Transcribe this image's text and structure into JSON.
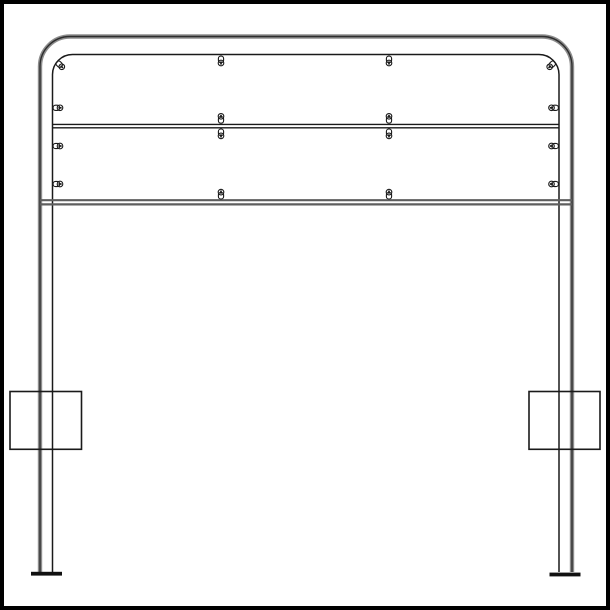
{
  "drawing": {
    "kind": "technical-elevation-line-drawing",
    "canvas": {
      "width": 610,
      "height": 610,
      "background": "#ffffff"
    },
    "border": {
      "color": "#000000",
      "stroke_width": 4,
      "inset": 2
    },
    "colors": {
      "line": "#1a1a1a",
      "tube_halo": "#8d8d8d",
      "tube_core": "#2e2e2e",
      "rail_gray": "#5e5e5e",
      "foot_fill": "#111111"
    },
    "tube_frame": {
      "outer": {
        "left_x": 40,
        "right_x": 572,
        "top_y": 36.5,
        "corner_radius": 30,
        "bottom_y": 572,
        "halo_width": 4.4,
        "core_width": 1.4
      },
      "inner": {
        "left_x": 52.5,
        "right_x": 559,
        "top_y": 54.5,
        "corner_radius": 20,
        "bottom_y": 572,
        "stroke_width": 1.5
      }
    },
    "rails": [
      {
        "name": "panel-divider-rail",
        "lines_y": [
          124.4,
          127.8
        ],
        "x1": 52.5,
        "x2": 559,
        "color_key": "line",
        "stroke_width": 1.4
      },
      {
        "name": "bottom-rail",
        "lines_y": [
          200.2,
          204.4
        ],
        "x1": 40,
        "x2": 572,
        "color_key": "rail_gray",
        "stroke_width": 2.2
      }
    ],
    "feet": [
      {
        "name": "left-foot-plate",
        "x": 31,
        "y": 571.8,
        "w": 31,
        "h": 3.8
      },
      {
        "name": "right-foot-plate",
        "x": 549.5,
        "y": 572.6,
        "w": 31,
        "h": 3.8
      }
    ],
    "side_boxes": [
      {
        "name": "left-side-box",
        "x": 10,
        "y": 391.5,
        "w": 71.5,
        "h": 57.8,
        "stroke_width": 1.6
      },
      {
        "name": "right-side-box",
        "x": 529,
        "y": 391.5,
        "w": 71,
        "h": 57.8,
        "stroke_width": 1.6
      }
    ],
    "fasteners": [
      {
        "x": 52.5,
        "y": 107.8,
        "angle": 0
      },
      {
        "x": 52.5,
        "y": 146.0,
        "angle": 0
      },
      {
        "x": 52.5,
        "y": 184.0,
        "angle": 0
      },
      {
        "x": 559,
        "y": 107.8,
        "angle": 180
      },
      {
        "x": 559,
        "y": 146.0,
        "angle": 180
      },
      {
        "x": 559,
        "y": 184.0,
        "angle": 180
      },
      {
        "x": 56.5,
        "y": 61.5,
        "angle": 45
      },
      {
        "x": 555,
        "y": 61.5,
        "angle": 135
      },
      {
        "x": 221,
        "y": 55.5,
        "angle": 90
      },
      {
        "x": 389,
        "y": 55.5,
        "angle": 90
      },
      {
        "x": 221,
        "y": 123.8,
        "angle": -90
      },
      {
        "x": 389,
        "y": 123.8,
        "angle": -90
      },
      {
        "x": 221,
        "y": 128.4,
        "angle": 90
      },
      {
        "x": 389,
        "y": 128.4,
        "angle": 90
      },
      {
        "x": 221,
        "y": 199.6,
        "angle": -90
      },
      {
        "x": 389,
        "y": 199.6,
        "angle": -90
      }
    ],
    "fastener_glyph": {
      "tab": {
        "x": 0.6,
        "y": -2.6,
        "w": 6.6,
        "h": 5.2,
        "rx": 2.4,
        "stroke_width": 1.1
      },
      "head": {
        "cx": 7.5,
        "cy": 0,
        "r": 2.8,
        "stroke_width": 1.1
      },
      "slot": {
        "x": 5.9,
        "y": -0.85,
        "w": 3.2,
        "h": 1.7
      }
    }
  }
}
